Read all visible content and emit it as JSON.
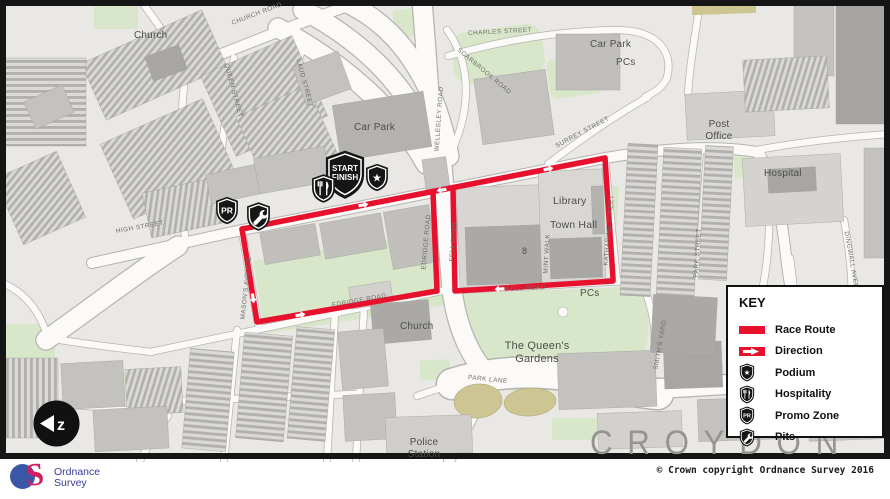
{
  "colors": {
    "route_red": "#e8112d",
    "shield_black": "#161616",
    "map_green": "#d8e7c9",
    "khaki": "#cdc592",
    "road_white": "#fbfaf8",
    "building_gray": "#c3c2bf",
    "croydon_gray": "#95948e"
  },
  "map": {
    "city_label": "CROYDON",
    "place_labels": [
      "Church",
      "Car Park",
      "Car Park",
      "PCs",
      "Post\nOffice",
      "Hospital",
      "Library",
      "Town Hall",
      "PCs",
      "Church",
      "The Queen's\nGardens",
      "Police\nStation",
      "8"
    ],
    "street_labels": [
      "HIGH STREET",
      "CHURCH ROAD",
      "CHARLES STREET",
      "SCARBROOK ROAD",
      "SURREY STREET",
      "WELLESLEY ROAD",
      "MASON'S AVENUE",
      "EDRIDGE ROAD",
      "EDRIDGE ROAD",
      "FELL ROAD",
      "FELL ROAD",
      "MINT WALK",
      "KATHARINE STREET",
      "PARK STREET",
      "DINGWALL AVENUE",
      "PARK LANE",
      "SMITH'S YARD",
      "LAUD STREET",
      "QUEEN STREET"
    ]
  },
  "markers": {
    "start_finish_line1": "START",
    "start_finish_line2": "FINISH",
    "promo_text": "PR",
    "podium_star": "★"
  },
  "key": {
    "title": "KEY",
    "items": [
      {
        "icon": "race-route-swatch",
        "label": "Race Route"
      },
      {
        "icon": "direction-arrow",
        "label": "Direction"
      },
      {
        "icon": "podium-shield",
        "label": "Podium"
      },
      {
        "icon": "hospitality-shield",
        "label": "Hospitality"
      },
      {
        "icon": "promo-zone-shield",
        "label": "Promo Zone"
      },
      {
        "icon": "pits-shield",
        "label": "Pits"
      }
    ]
  },
  "compass": {
    "glyph": "z"
  },
  "footer": {
    "copyright": "© Crown copyright Ordnance Survey 2016",
    "logo_line1": "Ordnance",
    "logo_line2": "Survey"
  }
}
